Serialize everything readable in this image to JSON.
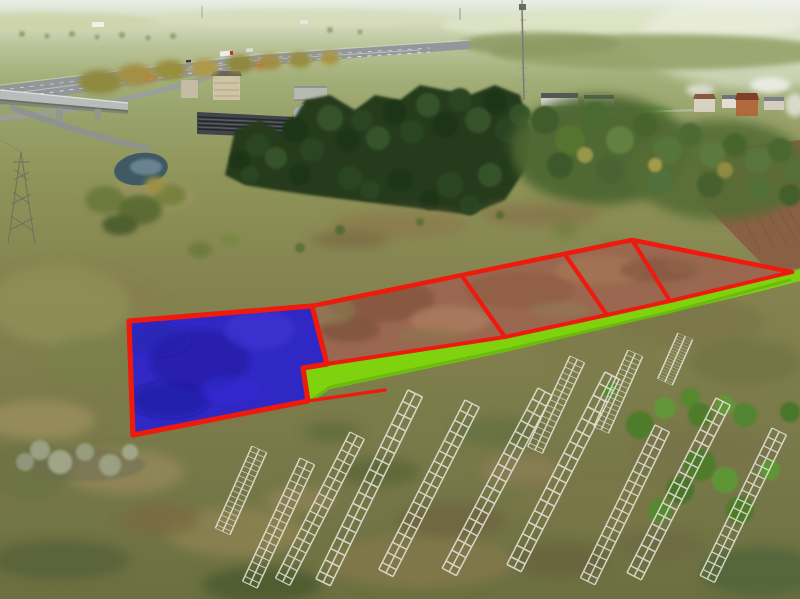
{
  "meta": {
    "description": "Aerial drone photo of rural land with five surveyed building plots outlined in red; the featured plot is filled blue and a lime-green access road strip runs along the front of the parcels. A motorway with an overpass, an industrial warehouse, conifer woodland, a small pond, a telecom mast and village houses sit in the background; dismantled white metal lattice frames lie on the scrubland in the foreground.",
    "plot_count": 5
  },
  "palette": {
    "annotation_red": "#ee1a0e",
    "featured_plot_blue": "#2f28c4",
    "featured_plot_blue_dark": "#1f1898",
    "access_road_green": "#7fd30e",
    "access_road_green_dark": "#63b00c",
    "parcel_soil_brown": "#9a6750",
    "foreground_scrub": "#7d7c4b",
    "conifer_green": "#24391c",
    "pond_water": "#3f5a64",
    "highway_asphalt": "#94979a",
    "frame_white": "#e4e4da"
  },
  "annotations": {
    "blue_plot": {
      "points": "129,321 312,306 327,364 303,368 308,401 133,435",
      "fill": "#2f28c4",
      "stroke": "#ee1a0e"
    },
    "brown_parcels": {
      "points": "312,306 632,240 792,272 670,301 607,315 505,337 330,364 327,364",
      "fill": "#9a6750"
    },
    "access_road": {
      "points": "303,368 327,364 505,337 607,315 670,301 792,272 800,269 800,281 757,292 670,313 505,352 330,389 310,403",
      "fill": "#7fd30e"
    },
    "boundary_back": {
      "points": "312,306 632,240 792,272",
      "stroke": "#ee1a0e"
    },
    "boundary_front": {
      "points": "303,368 327,364 505,337 607,315 670,301 792,272",
      "stroke": "#ee1a0e"
    },
    "divider_1": {
      "points": "462,276 505,337",
      "stroke": "#ee1a0e"
    },
    "divider_2": {
      "points": "566,256 607,315",
      "stroke": "#ee1a0e"
    },
    "divider_3": {
      "points": "632,240 670,301",
      "stroke": "#ee1a0e"
    },
    "road_edge_left": {
      "points": "308,401 385,390",
      "stroke": "#ee1a0e"
    }
  }
}
